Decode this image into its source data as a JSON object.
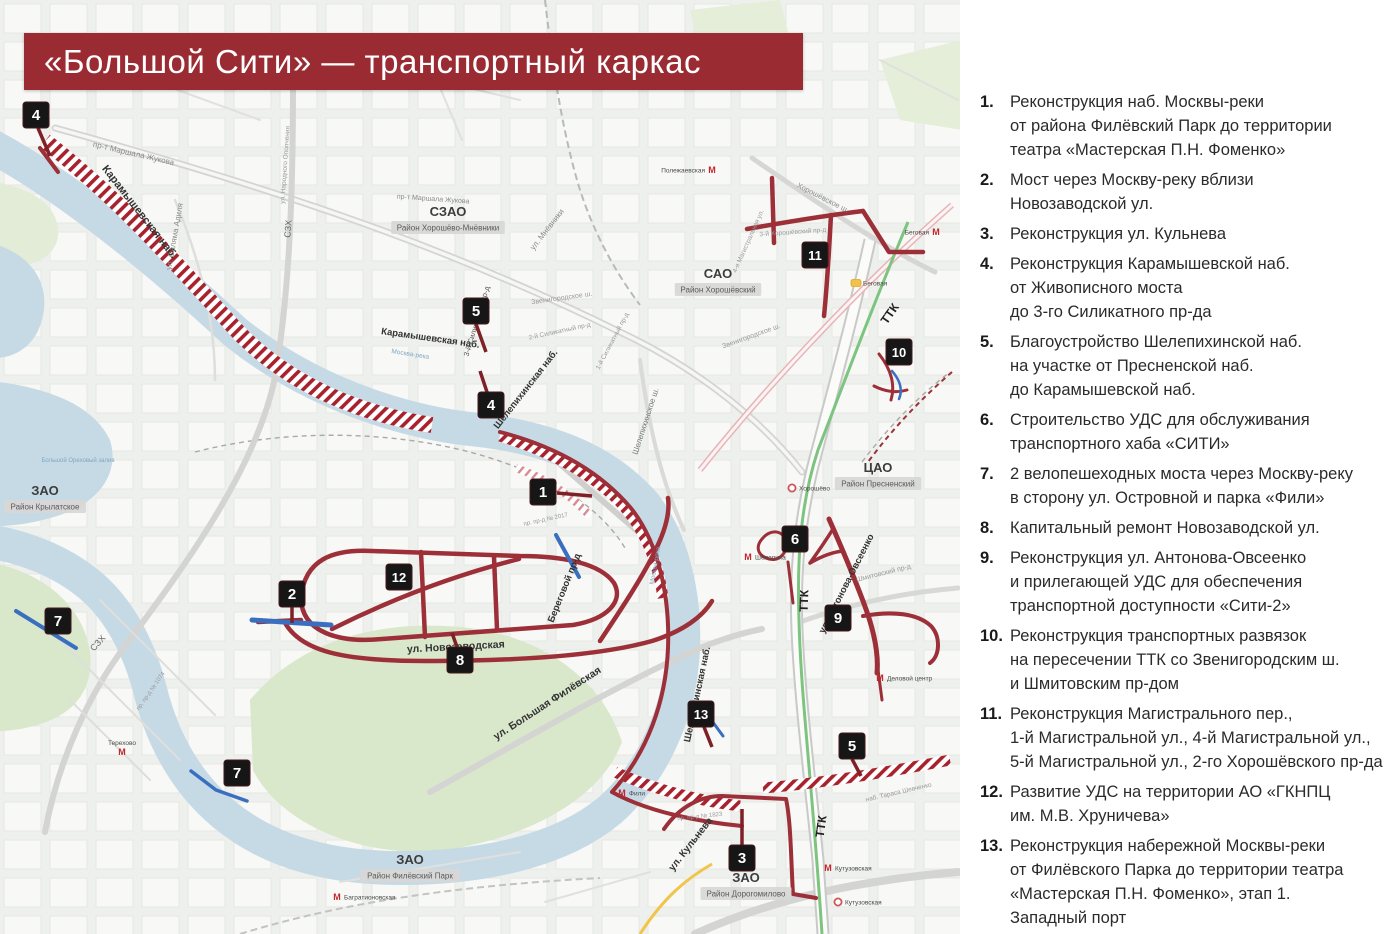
{
  "title": "«Большой Сити» — транспортный каркас",
  "colors": {
    "banner": "#9a2b33",
    "project_road": "#9c2f38",
    "hatch_red": "#a8222e",
    "marker_bg": "#161616",
    "water": "#c6dae6",
    "park": "#d9e7cb",
    "mcc_green": "#7cc47f",
    "bridge_blue": "#3a6fc0",
    "metro_red": "#c2272d"
  },
  "logos": [
    {
      "name": "moscow-coat-of-arms"
    },
    {
      "name": "moskomarkhitektura-emblem"
    }
  ],
  "legend": {
    "items": [
      {
        "num": "1.",
        "text": "Реконструкция наб. Москвы-реки\nот района Филёвский Парк до территории\nтеатра «Мастерская П.Н. Фоменко»"
      },
      {
        "num": "2.",
        "text": "Мост через Москву-реку вблизи\nНовозаводской ул."
      },
      {
        "num": "3.",
        "text": "Реконструкция ул. Кульнева"
      },
      {
        "num": "4.",
        "text": "Реконструкция Карамышевской наб.\nот Живописного моста\nдо 3-го Силикатного пр-да"
      },
      {
        "num": "5.",
        "text": "Благоустройство Шелепихинской наб.\nна участке от Пресненской наб.\nдо Карамышевской наб."
      },
      {
        "num": "6.",
        "text": "Строительство УДС для обслуживания\nтранспортного хаба «СИТИ»"
      },
      {
        "num": "7.",
        "text": "2 велопешеходных моста через Москву-реку\nв сторону ул. Островной и парка «Фили»"
      },
      {
        "num": "8.",
        "text": "Капитальный ремонт Новозаводской ул."
      },
      {
        "num": "9.",
        "text": "Реконструкция ул. Антонова-Овсеенко\nи прилегающей УДС для обеспечения\nтранспортной доступности «Сити-2»"
      },
      {
        "num": "10.",
        "text": "Реконструкция транспортных развязок\nна пересечении ТТК со Звенигородским ш.\nи Шмитовским пр-дом"
      },
      {
        "num": "11.",
        "text": "Реконструкция Магистрального пер.,\n1-й Магистральной ул., 4-й Магистральной ул.,\n5-й Магистральной ул., 2-го Хорошёвского пр-да"
      },
      {
        "num": "12.",
        "text": "Развитие УДС на территории АО «ГКНПЦ\nим. М.В. Хруничева»"
      },
      {
        "num": "13.",
        "text": "Реконструкция набережной Москвы-реки\nот Филёвского Парка до территории театра\n«Мастерская П.Н. Фоменко», этап 1.\nЗападный порт"
      }
    ]
  },
  "map": {
    "districts": [
      {
        "okrug": "СЗАО",
        "district": "Район Хорошёво-Мнёвники",
        "x": 448,
        "y": 216
      },
      {
        "okrug": "САО",
        "district": "Район Хорошёвский",
        "x": 718,
        "y": 278
      },
      {
        "okrug": "ЦАО",
        "district": "Район Пресненский",
        "x": 878,
        "y": 472
      },
      {
        "okrug": "ЗАО",
        "district": "Район Крылатское",
        "x": 45,
        "y": 495
      },
      {
        "okrug": "ЗАО",
        "district": "Район Филёвский Парк",
        "x": 410,
        "y": 864
      },
      {
        "okrug": "ЗАО",
        "district": "Район Дорогомилово",
        "x": 746,
        "y": 882
      }
    ],
    "street_labels": [
      {
        "text": "Карамышевская наб.",
        "x": 137,
        "y": 214,
        "rot": 52,
        "size": 11,
        "color": "#333333",
        "bold": true
      },
      {
        "text": "Карамышевская наб.",
        "x": 430,
        "y": 341,
        "rot": 8,
        "size": 9.5,
        "color": "#333333",
        "bold": true
      },
      {
        "text": "пр-т Маршала Жукова",
        "x": 133,
        "y": 156,
        "rot": 13,
        "size": 8,
        "color": "#8a8a8a"
      },
      {
        "text": "пр-т Маршала Жукова",
        "x": 433,
        "y": 201,
        "rot": 4,
        "size": 7,
        "color": "#8a8a8a"
      },
      {
        "text": "ул. Саляма Адиля",
        "x": 177,
        "y": 237,
        "rot": -80,
        "size": 8,
        "color": "#8a8a8a"
      },
      {
        "text": "ул. Народного Ополчения",
        "x": 287,
        "y": 165,
        "rot": -86,
        "size": 6.5,
        "color": "#9a9a9a"
      },
      {
        "text": "СЗХ",
        "x": 291,
        "y": 229,
        "rot": -86,
        "size": 9,
        "color": "#666666"
      },
      {
        "text": "СЗХ",
        "x": 100,
        "y": 645,
        "rot": -48,
        "size": 9,
        "color": "#666666"
      },
      {
        "text": "ул. Мнёвники",
        "x": 549,
        "y": 231,
        "rot": -52,
        "size": 8,
        "color": "#8a8a8a"
      },
      {
        "text": "3-й Силикатный пр-д",
        "x": 479,
        "y": 322,
        "rot": -73,
        "size": 7.5,
        "color": "#555555"
      },
      {
        "text": "2-й Силикатный пр-д",
        "x": 560,
        "y": 333,
        "rot": -12,
        "size": 6.5,
        "color": "#9a9a9a"
      },
      {
        "text": "1-й Силикатный пр-д",
        "x": 614,
        "y": 342,
        "rot": -62,
        "size": 6.5,
        "color": "#9a9a9a"
      },
      {
        "text": "Звенигородское ш.",
        "x": 562,
        "y": 300,
        "rot": -8,
        "size": 7,
        "color": "#9a9a9a"
      },
      {
        "text": "Звенигородское ш.",
        "x": 752,
        "y": 338,
        "rot": -20,
        "size": 7,
        "color": "#9a9a9a"
      },
      {
        "text": "Шелепихинская наб.",
        "x": 528,
        "y": 391,
        "rot": -52,
        "size": 9.5,
        "color": "#333333",
        "bold": true
      },
      {
        "text": "Шелепихинская наб.",
        "x": 700,
        "y": 695,
        "rot": -78,
        "size": 9.5,
        "color": "#333333",
        "bold": true
      },
      {
        "text": "Шелепихинское ш.",
        "x": 648,
        "y": 422,
        "rot": -72,
        "size": 8,
        "color": "#777777"
      },
      {
        "text": "Хорошёвское ш.",
        "x": 822,
        "y": 200,
        "rot": 27,
        "size": 7.5,
        "color": "#8a8a8a"
      },
      {
        "text": "3-й Хорошёвский пр-д",
        "x": 793,
        "y": 234,
        "rot": -4,
        "size": 6.5,
        "color": "#9a9a9a"
      },
      {
        "text": "4-я Магистральная ул.",
        "x": 750,
        "y": 242,
        "rot": -66,
        "size": 6.5,
        "color": "#9a9a9a"
      },
      {
        "text": "ТТК",
        "x": 893,
        "y": 316,
        "rot": -55,
        "size": 12,
        "color": "#222222",
        "bold": true
      },
      {
        "text": "ТТК",
        "x": 808,
        "y": 601,
        "rot": -88,
        "size": 12,
        "color": "#222222",
        "bold": true
      },
      {
        "text": "ТТК",
        "x": 825,
        "y": 827,
        "rot": -82,
        "size": 12,
        "color": "#222222",
        "bold": true
      },
      {
        "text": "ул. Новозаводская",
        "x": 456,
        "y": 650,
        "rot": -3,
        "size": 10.5,
        "color": "#333333",
        "bold": true
      },
      {
        "text": "Береговой пр-д",
        "x": 567,
        "y": 589,
        "rot": -68,
        "size": 9.5,
        "color": "#333333",
        "bold": true
      },
      {
        "text": "ул. Большая Филёвская",
        "x": 549,
        "y": 706,
        "rot": -33,
        "size": 10.5,
        "color": "#333333",
        "bold": true
      },
      {
        "text": "ул. Антонова-Овсеенко",
        "x": 849,
        "y": 585,
        "rot": -63,
        "size": 9.5,
        "color": "#333333",
        "bold": true
      },
      {
        "text": "Шмитовский пр-д",
        "x": 884,
        "y": 575,
        "rot": -14,
        "size": 7,
        "color": "#9a9a9a"
      },
      {
        "text": "ул. Кульнева",
        "x": 693,
        "y": 846,
        "rot": -52,
        "size": 10,
        "color": "#333333",
        "bold": true
      },
      {
        "text": "наб. Тараса Шевченко",
        "x": 899,
        "y": 794,
        "rot": -13,
        "size": 6.5,
        "color": "#9a9a9a"
      },
      {
        "text": "пр. пр-д № 1074",
        "x": 152,
        "y": 692,
        "rot": -55,
        "size": 6,
        "color": "#9a9a9a"
      },
      {
        "text": "пр. пр-д № 2017",
        "x": 546,
        "y": 521,
        "rot": -12,
        "size": 6,
        "color": "#9a9a9a"
      },
      {
        "text": "пр. пр-д № 1823",
        "x": 700,
        "y": 818,
        "rot": -6,
        "size": 6,
        "color": "#9a9a9a"
      },
      {
        "text": "Москва-река",
        "x": 410,
        "y": 356,
        "rot": 9,
        "size": 6.5,
        "color": "#7fa8c0"
      },
      {
        "text": "Москва-река",
        "x": 657,
        "y": 566,
        "rot": -80,
        "size": 6.5,
        "color": "#7fa8c0"
      },
      {
        "text": "Большой Ореховый залив",
        "x": 78,
        "y": 462,
        "rot": 0,
        "size": 6,
        "color": "#7fa8c0"
      }
    ],
    "markers": [
      {
        "n": "4",
        "x": 36,
        "y": 115,
        "stem": [
          38,
          128,
          50,
          156
        ]
      },
      {
        "n": "5",
        "x": 476,
        "y": 311,
        "stem": [
          476,
          324,
          486,
          352
        ]
      },
      {
        "n": "4",
        "x": 491,
        "y": 405,
        "stem": [
          487,
          392,
          480,
          371
        ]
      },
      {
        "n": "1",
        "x": 543,
        "y": 492,
        "stem": [
          557,
          493,
          592,
          496
        ]
      },
      {
        "n": "11",
        "x": 815,
        "y": 255
      },
      {
        "n": "10",
        "x": 899,
        "y": 352
      },
      {
        "n": "6",
        "x": 795,
        "y": 539
      },
      {
        "n": "9",
        "x": 838,
        "y": 618
      },
      {
        "n": "12",
        "x": 399,
        "y": 577
      },
      {
        "n": "2",
        "x": 292,
        "y": 594,
        "stem": [
          292,
          607,
          292,
          623
        ]
      },
      {
        "n": "8",
        "x": 460,
        "y": 660,
        "stem": [
          457,
          647,
          452,
          633
        ]
      },
      {
        "n": "7",
        "x": 58,
        "y": 621
      },
      {
        "n": "7",
        "x": 237,
        "y": 773
      },
      {
        "n": "13",
        "x": 701,
        "y": 714,
        "stem": [
          704,
          727,
          712,
          747
        ]
      },
      {
        "n": "3",
        "x": 742,
        "y": 858,
        "stem": [
          742,
          845,
          742,
          809
        ]
      },
      {
        "n": "5",
        "x": 852,
        "y": 746,
        "stem": [
          852,
          759,
          861,
          776
        ]
      }
    ],
    "stations": [
      {
        "kind": "metro",
        "name": "Полежаевская",
        "x": 712,
        "y": 170,
        "side": "left"
      },
      {
        "kind": "metro",
        "name": "Беговая",
        "x": 936,
        "y": 232,
        "side": "left"
      },
      {
        "kind": "d2",
        "name": "Беговая",
        "x": 856,
        "y": 283,
        "side": "right"
      },
      {
        "kind": "mcc",
        "name": "Хорошёво",
        "x": 792,
        "y": 488,
        "side": "right"
      },
      {
        "kind": "metro",
        "name": "Шелепиха",
        "x": 748,
        "y": 557,
        "side": "right"
      },
      {
        "kind": "metro",
        "name": "Деловой центр",
        "x": 880,
        "y": 678,
        "side": "right"
      },
      {
        "kind": "metro",
        "name": "Кутузовская",
        "x": 828,
        "y": 868,
        "side": "right"
      },
      {
        "kind": "mcc",
        "name": "Кутузовская",
        "x": 838,
        "y": 902,
        "side": "right"
      },
      {
        "kind": "metro",
        "name": "Фили",
        "x": 622,
        "y": 793,
        "side": "right"
      },
      {
        "kind": "metro",
        "name": "Багратионовская",
        "x": 337,
        "y": 897,
        "side": "right"
      },
      {
        "kind": "metro",
        "name": "Терехово",
        "x": 122,
        "y": 752,
        "side": "top"
      }
    ]
  }
}
